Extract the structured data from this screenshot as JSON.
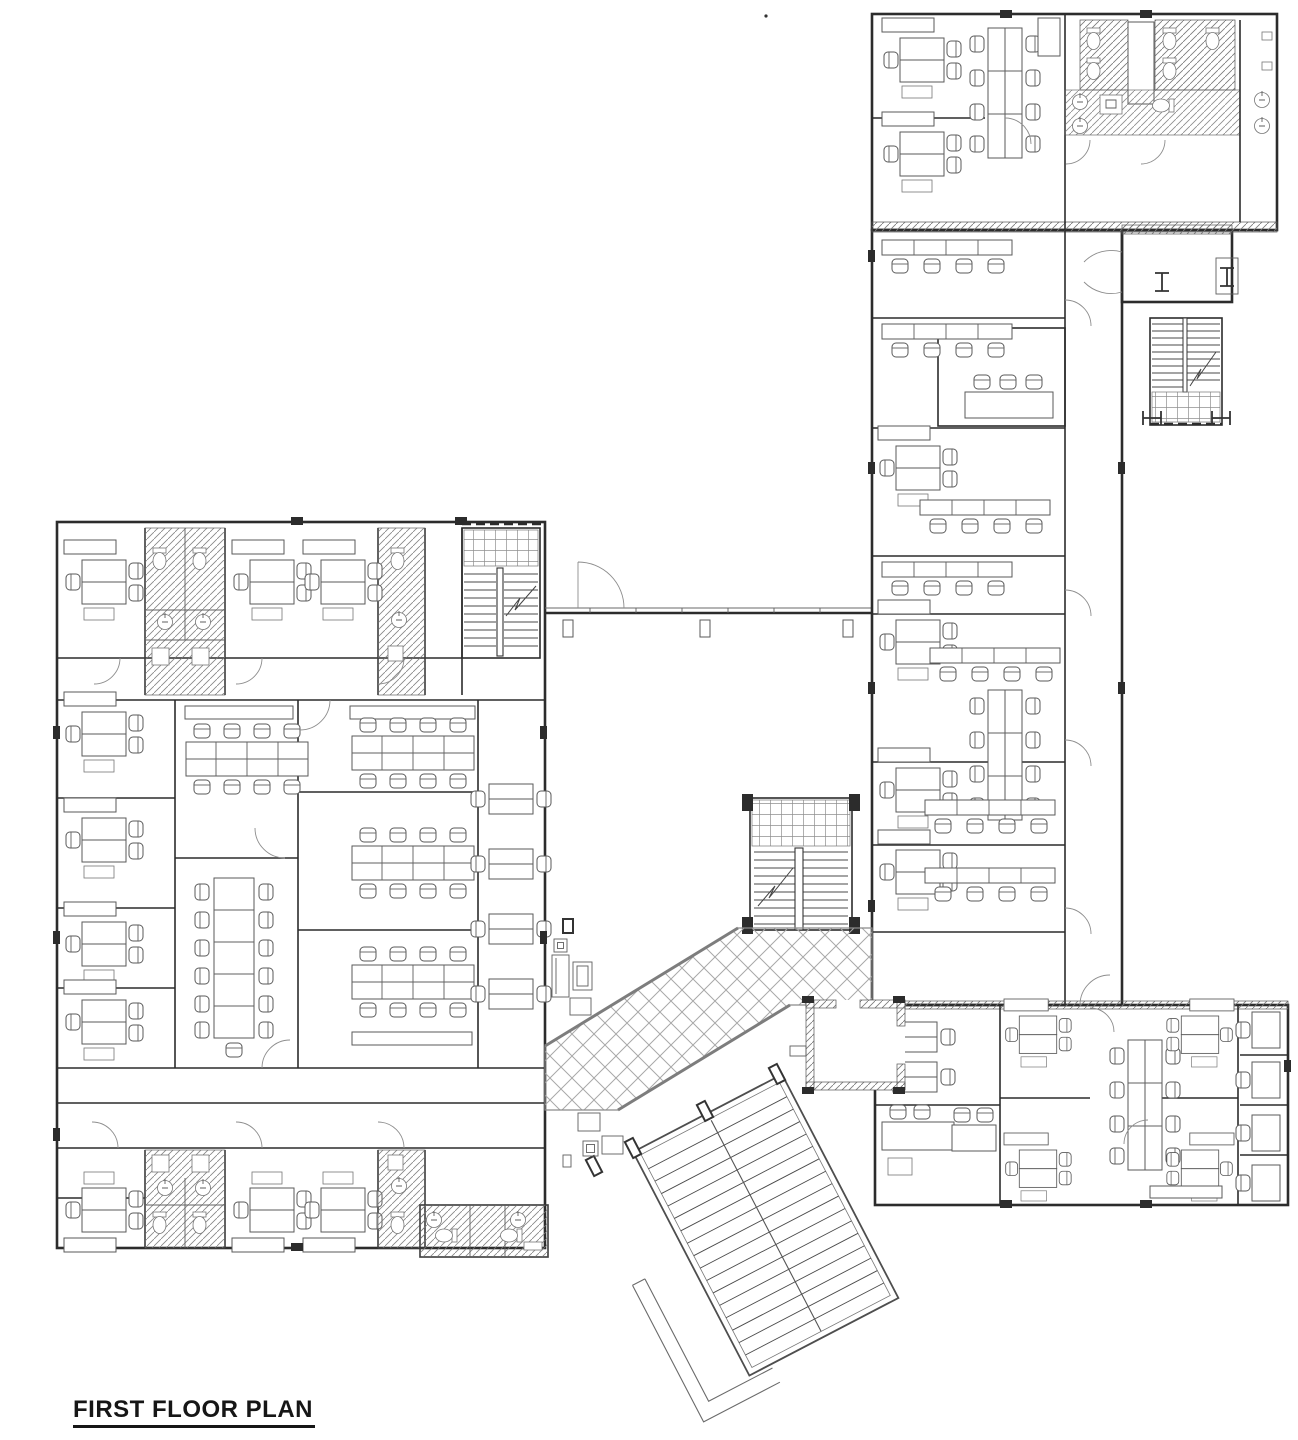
{
  "title": {
    "text": "FIRST FLOOR PLAN"
  },
  "drawing": {
    "background": "#ffffff",
    "wall_ink": "#2c2c2c",
    "floor_stripe_color": "#9a9a9a",
    "walkway_lattice_color": "#a8a8a8",
    "furniture_ink": "#5a5a5a"
  }
}
